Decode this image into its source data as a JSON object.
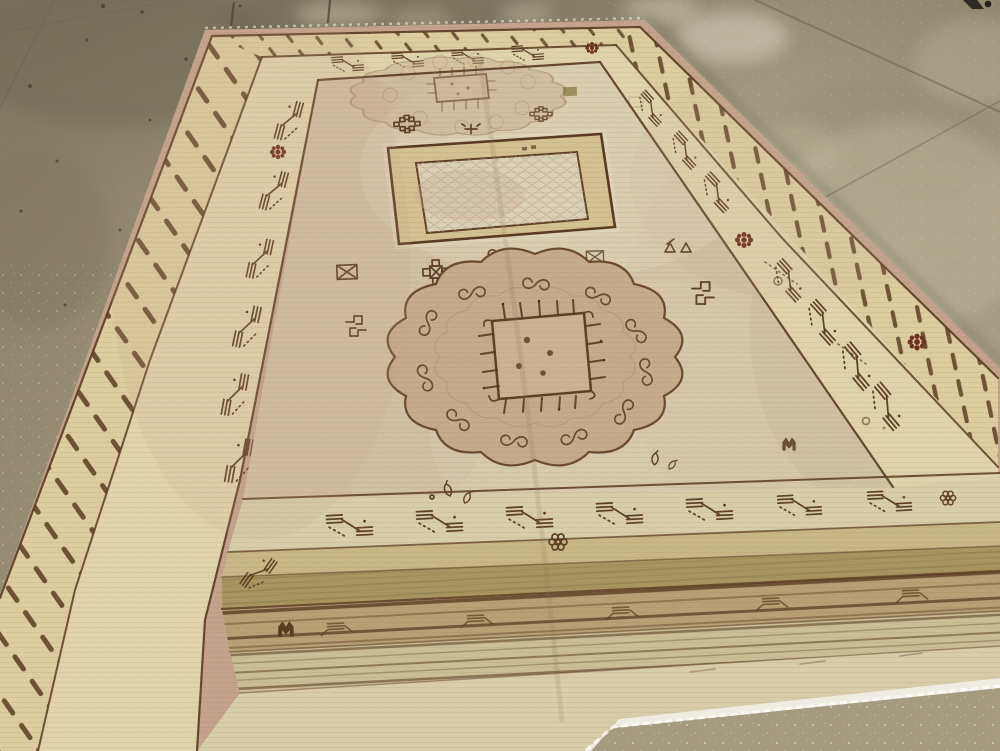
{
  "scene": {
    "description": "Faded antique Khotan carpet lying at an angle on a mottled polished concrete floor",
    "objects": [
      "antique Khotan rug",
      "polished concrete floor"
    ],
    "rug_features": [
      "scalloped central medallion with hooked square",
      "faded secondary medallion at top",
      "large open square cartouche",
      "tally-mark outer guard border",
      "hooked-S motif inner border with dark red rosettes",
      "scattered geometric field motifs",
      "striped kilim end bands",
      "white frayed bottom selvage"
    ],
    "floor_features": [
      "concrete expansion joint lines",
      "dark stains at upper left",
      "white speckled sheen",
      "bright light reflections",
      "small dark caster at top right corner"
    ]
  },
  "colors": {
    "floor_base": "#9a8f76",
    "floor_dark": "#6d6550",
    "floor_light": "#c2b99d",
    "floor_speckle_zone": "#a59c80",
    "rug_edge": "#c4a28c",
    "border_band": "#dccca0",
    "border_band_light": "#e0d3ac",
    "field": "#d5c7a9",
    "field_light": "#e3d9c0",
    "field_blush": "#c6a68c",
    "medallion_fill": "#c6aa8c",
    "medallion_square": "#cdb193",
    "square_band": "#d3c093",
    "square_fill": "#dad0b6",
    "outline": "#5a3a22",
    "outline_soft": "#8a6847",
    "accent_red": "#6f3322",
    "olive_light": "#c8b686",
    "olive_band": "#a8955f",
    "stripe_base": "#b89f75",
    "stripe_base2": "#cbbd96",
    "stripe_brown": "#5f432a",
    "pale_band": "#d8cda9",
    "white_selvage": "#efece1"
  }
}
